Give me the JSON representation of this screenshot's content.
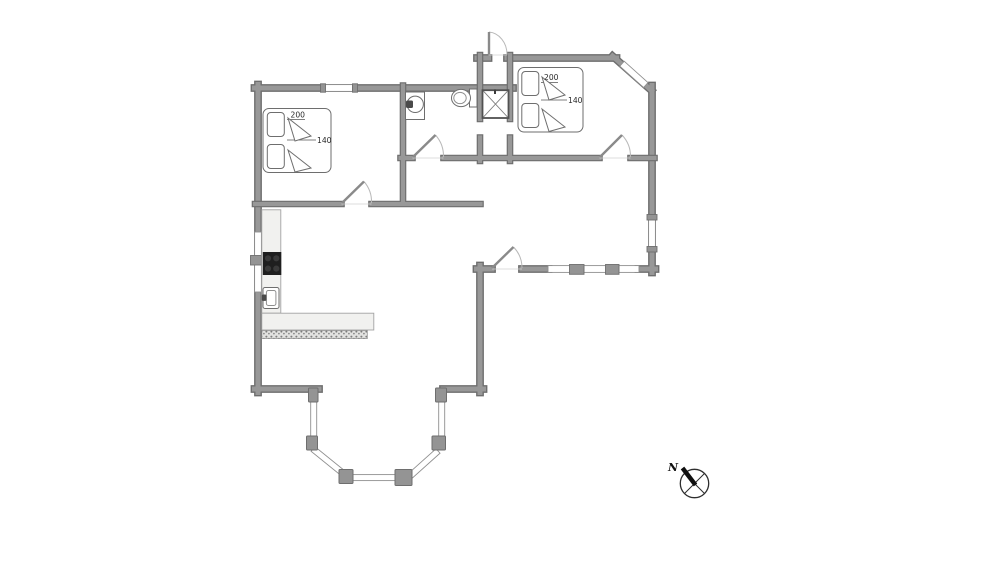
{
  "labels": {
    "bedroom1_bed_length": "200",
    "bedroom1_bed_width": "140",
    "bedroom2_bed_length": "200",
    "bedroom2_bed_width": "140",
    "compass_north": "N"
  },
  "colors": {
    "wall_fill": "#949494",
    "wall_edge": "#6e6e6e",
    "window_line": "#8f8f8f",
    "door_arc": "#b8b8b8",
    "fixture_outline": "#6e6e6e",
    "counter_fill": "#f1f1ef",
    "cooktop_fill": "#1f1f1f",
    "hatch_dot": "#7d7d7d",
    "text": "#2a2a2a",
    "background": "#ffffff"
  }
}
